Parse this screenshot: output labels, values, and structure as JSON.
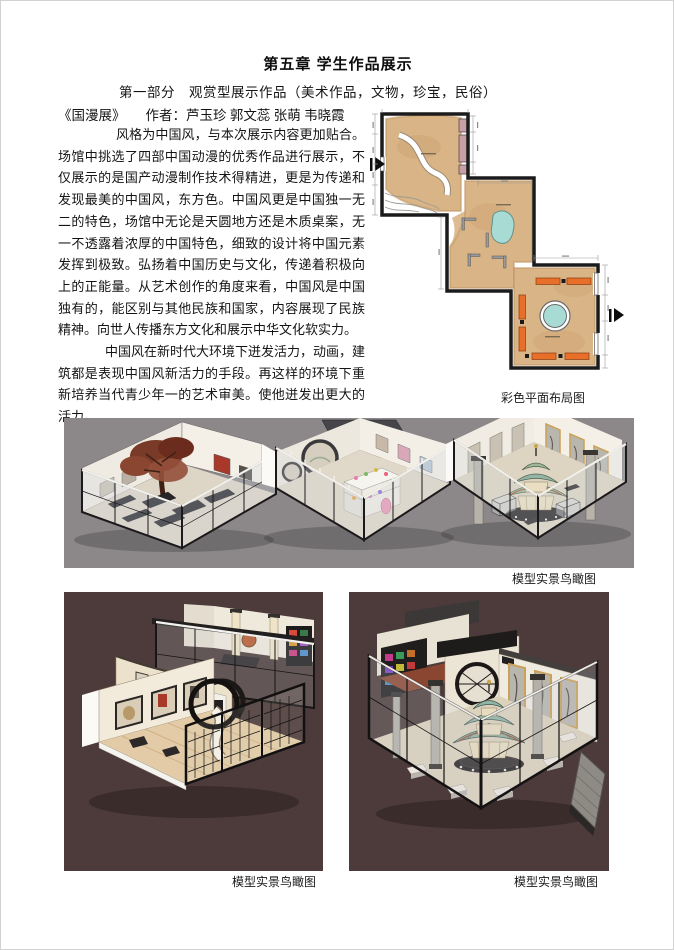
{
  "doc": {
    "title": "第五章 学生作品展示",
    "subtitle": "第一部分　观赏型展示作品（美术作品，文物，珍宝，民俗）",
    "work_title": "《国漫展》",
    "authors": "作者：芦玉珍 郭文蕊 张萌 韦晓霞",
    "paragraphs": [
      "风格为中国风，与本次展示内容更加贴合。场馆中挑选了四部中国动漫的优秀作品进行展示，不仅展示的是国产动漫制作技术得精进，更是为传递和发现最美的中国风，东方色。中国风更是中国独一无二的特色，场馆中无论是天圆地方还是木质桌案，无一不透露着浓厚的中国特色，细致的设计将中国元素发挥到极致。弘扬着中国历史与文化，传递着积极向上的正能量。从艺术创作的角度来看，中国风是中国独有的，能区别与其他民族和国家，内容展现了民族精神。向世人传播东方文化和展示中华文化软实力。",
      "中国风在新时代大环境下迸发活力，动画，建筑都是表现中国风新活力的手段。再这样的环境下重新培养当代青少年一的艺术审美。使他迸发出更大的活力。"
    ],
    "captions": {
      "plan": "彩色平面布局图",
      "wide": "模型实景鸟瞰图",
      "bottom_left": "模型实景鸟瞰图",
      "bottom_right": "模型实景鸟瞰图"
    }
  },
  "colors": {
    "model_wide_bg": "#8c8889",
    "model_bottom_bg": "#4c3b3a",
    "plan_floor": "#d9b487",
    "plan_floor_edge": "#c2935f",
    "plan_pond": "#a9dbd5",
    "plan_bench": "#e86f2a",
    "plan_case": "#c7a0a6",
    "wall_black": "#1b1b1b"
  }
}
